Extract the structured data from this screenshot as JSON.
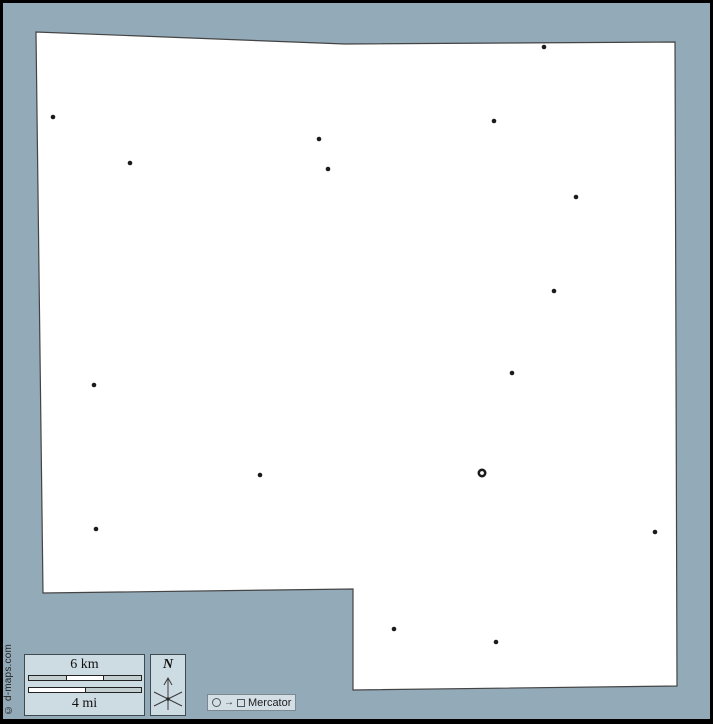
{
  "canvas": {
    "background": "#93aab9",
    "frame_color": "#000000"
  },
  "map": {
    "fill": "#ffffff",
    "stroke": "#444444",
    "dot_color": "#1b1b1b",
    "outline_points": "36,32 345,44 675,42 677,686 353,690 353,589 43,593",
    "cities": [
      [
        53,
        117
      ],
      [
        130,
        163
      ],
      [
        319,
        139
      ],
      [
        328,
        169
      ],
      [
        544,
        47
      ],
      [
        494,
        121
      ],
      [
        576,
        197
      ],
      [
        554,
        291
      ],
      [
        512,
        373
      ],
      [
        94,
        385
      ],
      [
        260,
        475
      ],
      [
        96,
        529
      ],
      [
        655,
        532
      ],
      [
        394,
        629
      ],
      [
        496,
        642
      ]
    ],
    "capital": {
      "x": 482,
      "y": 473
    }
  },
  "scale_bar": {
    "km_label": "6 km",
    "mi_label": "4 mi",
    "box_fill": "#cddbe2",
    "segment_gray": "#c2cecf",
    "segment_white": "#ffffff",
    "km_segments": [
      "gray",
      "white",
      "gray"
    ],
    "mi_segments": [
      "white",
      "gray"
    ]
  },
  "compass": {
    "label": "N"
  },
  "projection": {
    "arrow_char": "→",
    "label": "Mercator"
  },
  "copyright": {
    "text": "© d-maps.com"
  }
}
